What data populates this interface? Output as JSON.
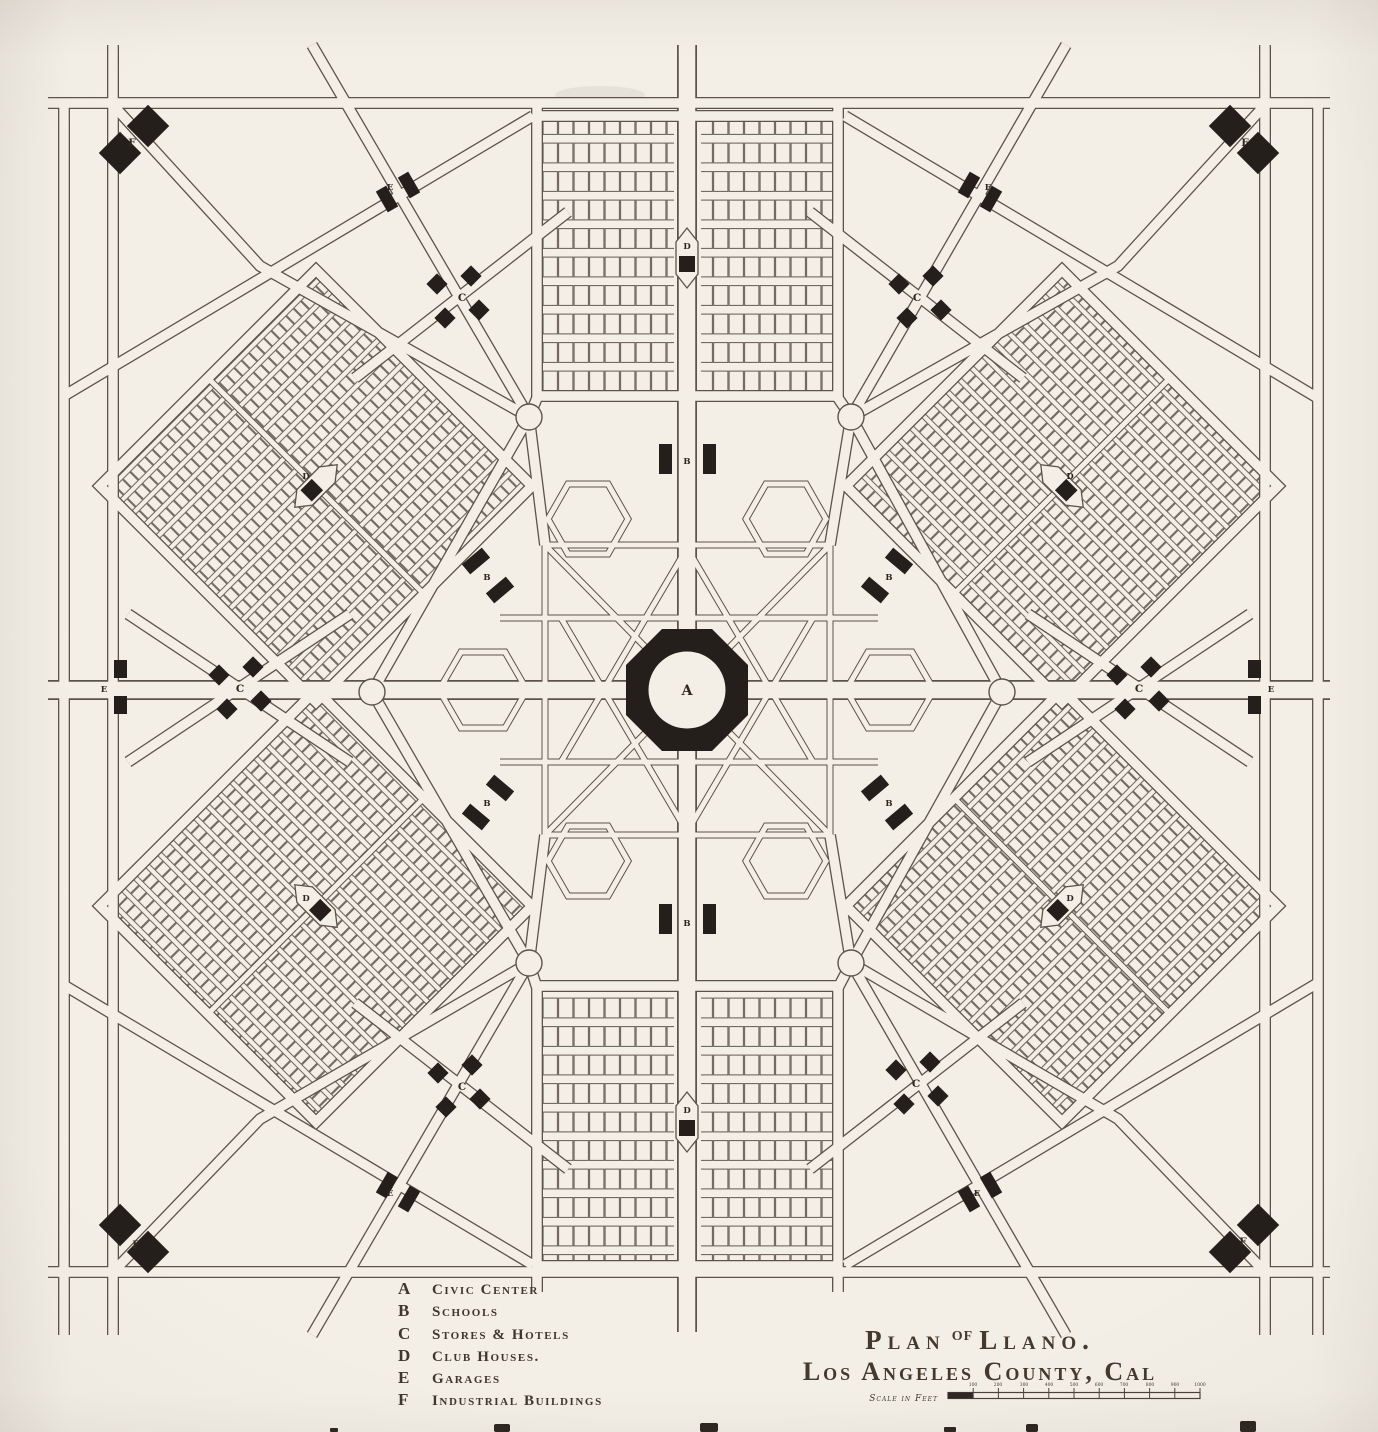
{
  "legend": {
    "items": [
      {
        "key": "A",
        "label": "Civic Center"
      },
      {
        "key": "B",
        "label": "Schools"
      },
      {
        "key": "C",
        "label": "Stores & Hotels"
      },
      {
        "key": "D",
        "label": "Club Houses."
      },
      {
        "key": "E",
        "label": "Garages"
      },
      {
        "key": "F",
        "label": "Industrial Buildings"
      }
    ]
  },
  "title": {
    "line1_pre": "Plan",
    "line1_of": "of",
    "line1_post": "Llano.",
    "line2": "Los Angeles County, Cal"
  },
  "scale_bar": {
    "label": "Scale in Feet",
    "ticks": [
      "100",
      "200",
      "300",
      "400",
      "500",
      "600",
      "700",
      "800",
      "900",
      "1000"
    ]
  },
  "colors": {
    "paper": "#f3efe7",
    "road_ink": "#5c534a",
    "lot_ink": "#6a6058",
    "building_ink": "#241f1b",
    "text_ink": "#3e372e"
  }
}
